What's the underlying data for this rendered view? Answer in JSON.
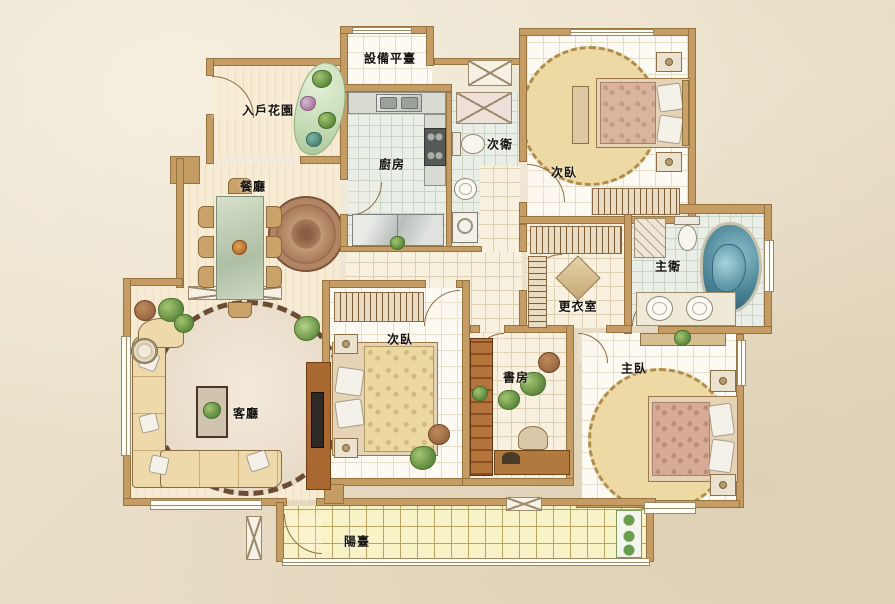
{
  "plan": {
    "title": "apartment floor plan",
    "rooms": {
      "equipment_platform": {
        "label": "設備平臺"
      },
      "entry_garden": {
        "label": "入戶花園"
      },
      "kitchen": {
        "label": "廚房"
      },
      "secondary_bath": {
        "label": "次衛"
      },
      "secondary_bedroom_top": {
        "label": "次臥"
      },
      "dining_room": {
        "label": "餐廳"
      },
      "master_bath": {
        "label": "主衛"
      },
      "dressing_room": {
        "label": "更衣室"
      },
      "secondary_bedroom_mid": {
        "label": "次臥"
      },
      "study": {
        "label": "書房"
      },
      "master_bedroom": {
        "label": "主臥"
      },
      "living_room": {
        "label": "客廳"
      },
      "balcony": {
        "label": "陽臺"
      }
    },
    "colors": {
      "paper": "#e9dec8",
      "wall": "#c59c63",
      "wood_floor": "#f7ecd3",
      "green_tile": "#e9eee6",
      "balcony_tile": "#f8f3c6",
      "rug": "#ecd9a3",
      "tub_teal": "#3a7386",
      "furniture_wood": "#a9682f"
    }
  }
}
